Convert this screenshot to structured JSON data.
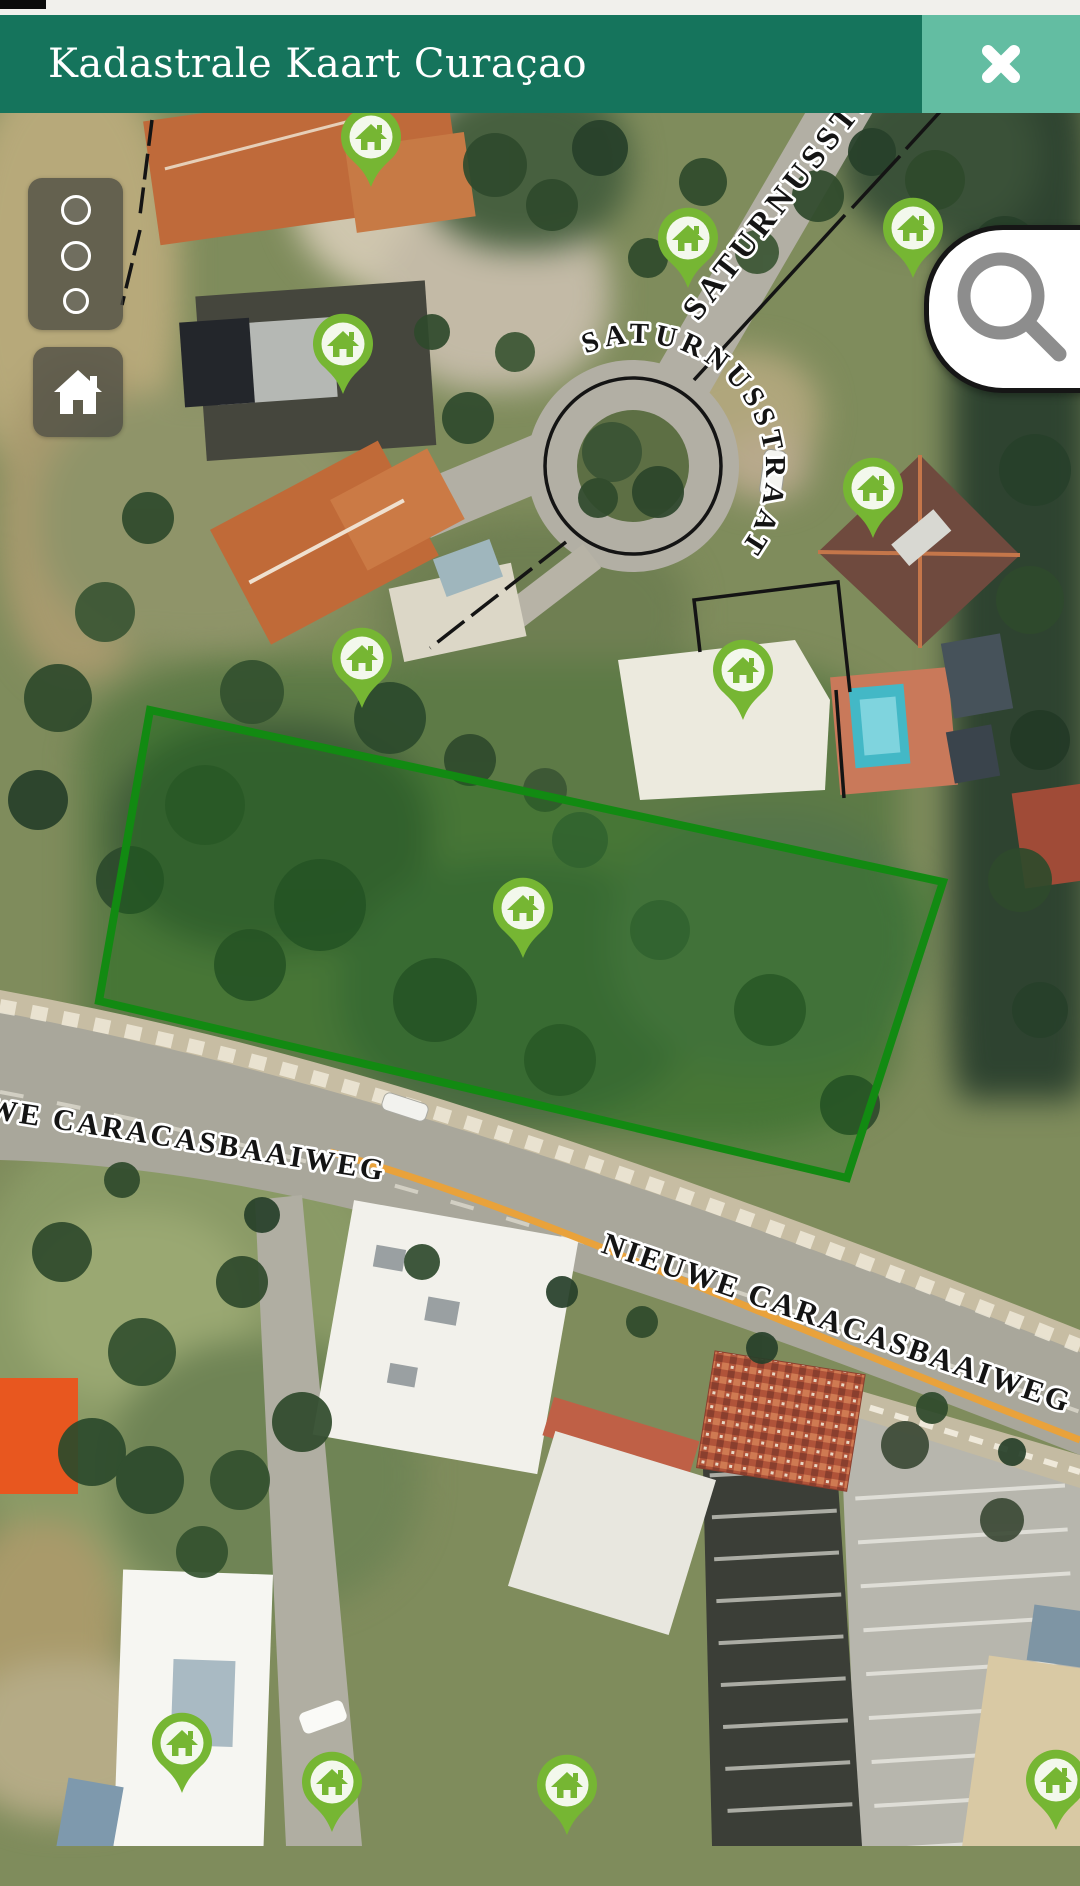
{
  "header": {
    "title": "Kadastrale Kaart Curaçao"
  },
  "icons": {
    "close-icon": "✕",
    "home-icon": "house",
    "search-icon": "magnifier",
    "marker-icon": "house-pin",
    "layers-icon": "three-circles"
  },
  "map": {
    "street_labels": {
      "roundabout": "SATURNUSSTRAAT",
      "northeast_road": "SATURNUSSTRAAT",
      "main_road_left": "NIEUWE CARACASBAAIWEG",
      "main_road_right": "NIEUWE CARACASBAAIWEG"
    },
    "parcel": {
      "outline_color": "#128a12",
      "fill_color": "rgba(20,110,20,0.30)"
    },
    "markers": {
      "count": 12,
      "pin_color": "#76b633"
    }
  },
  "colors": {
    "header_bg": "#15745c",
    "close_button_bg": "#63bda2",
    "route_line": "#e9a23b"
  }
}
